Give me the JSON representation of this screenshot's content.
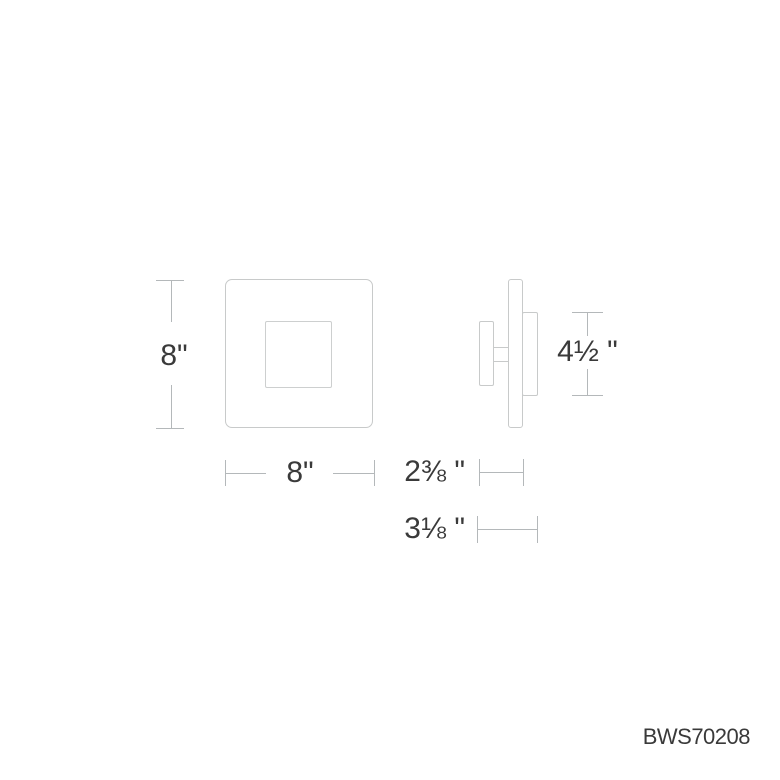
{
  "colors": {
    "background": "#ffffff",
    "outline": "#c8caca",
    "outline_light": "#cdcfcf",
    "dimension_line": "#b4b8ba",
    "text": "#3a3a3a"
  },
  "dimensions": {
    "front_height": {
      "label": "8\""
    },
    "front_width": {
      "label": "8\""
    },
    "side_height": {
      "label": "4½ \""
    },
    "depth_body": {
      "label": "2⅜ \""
    },
    "depth_overall": {
      "label": "3⅛ \""
    }
  },
  "product_code": "BWS70208"
}
